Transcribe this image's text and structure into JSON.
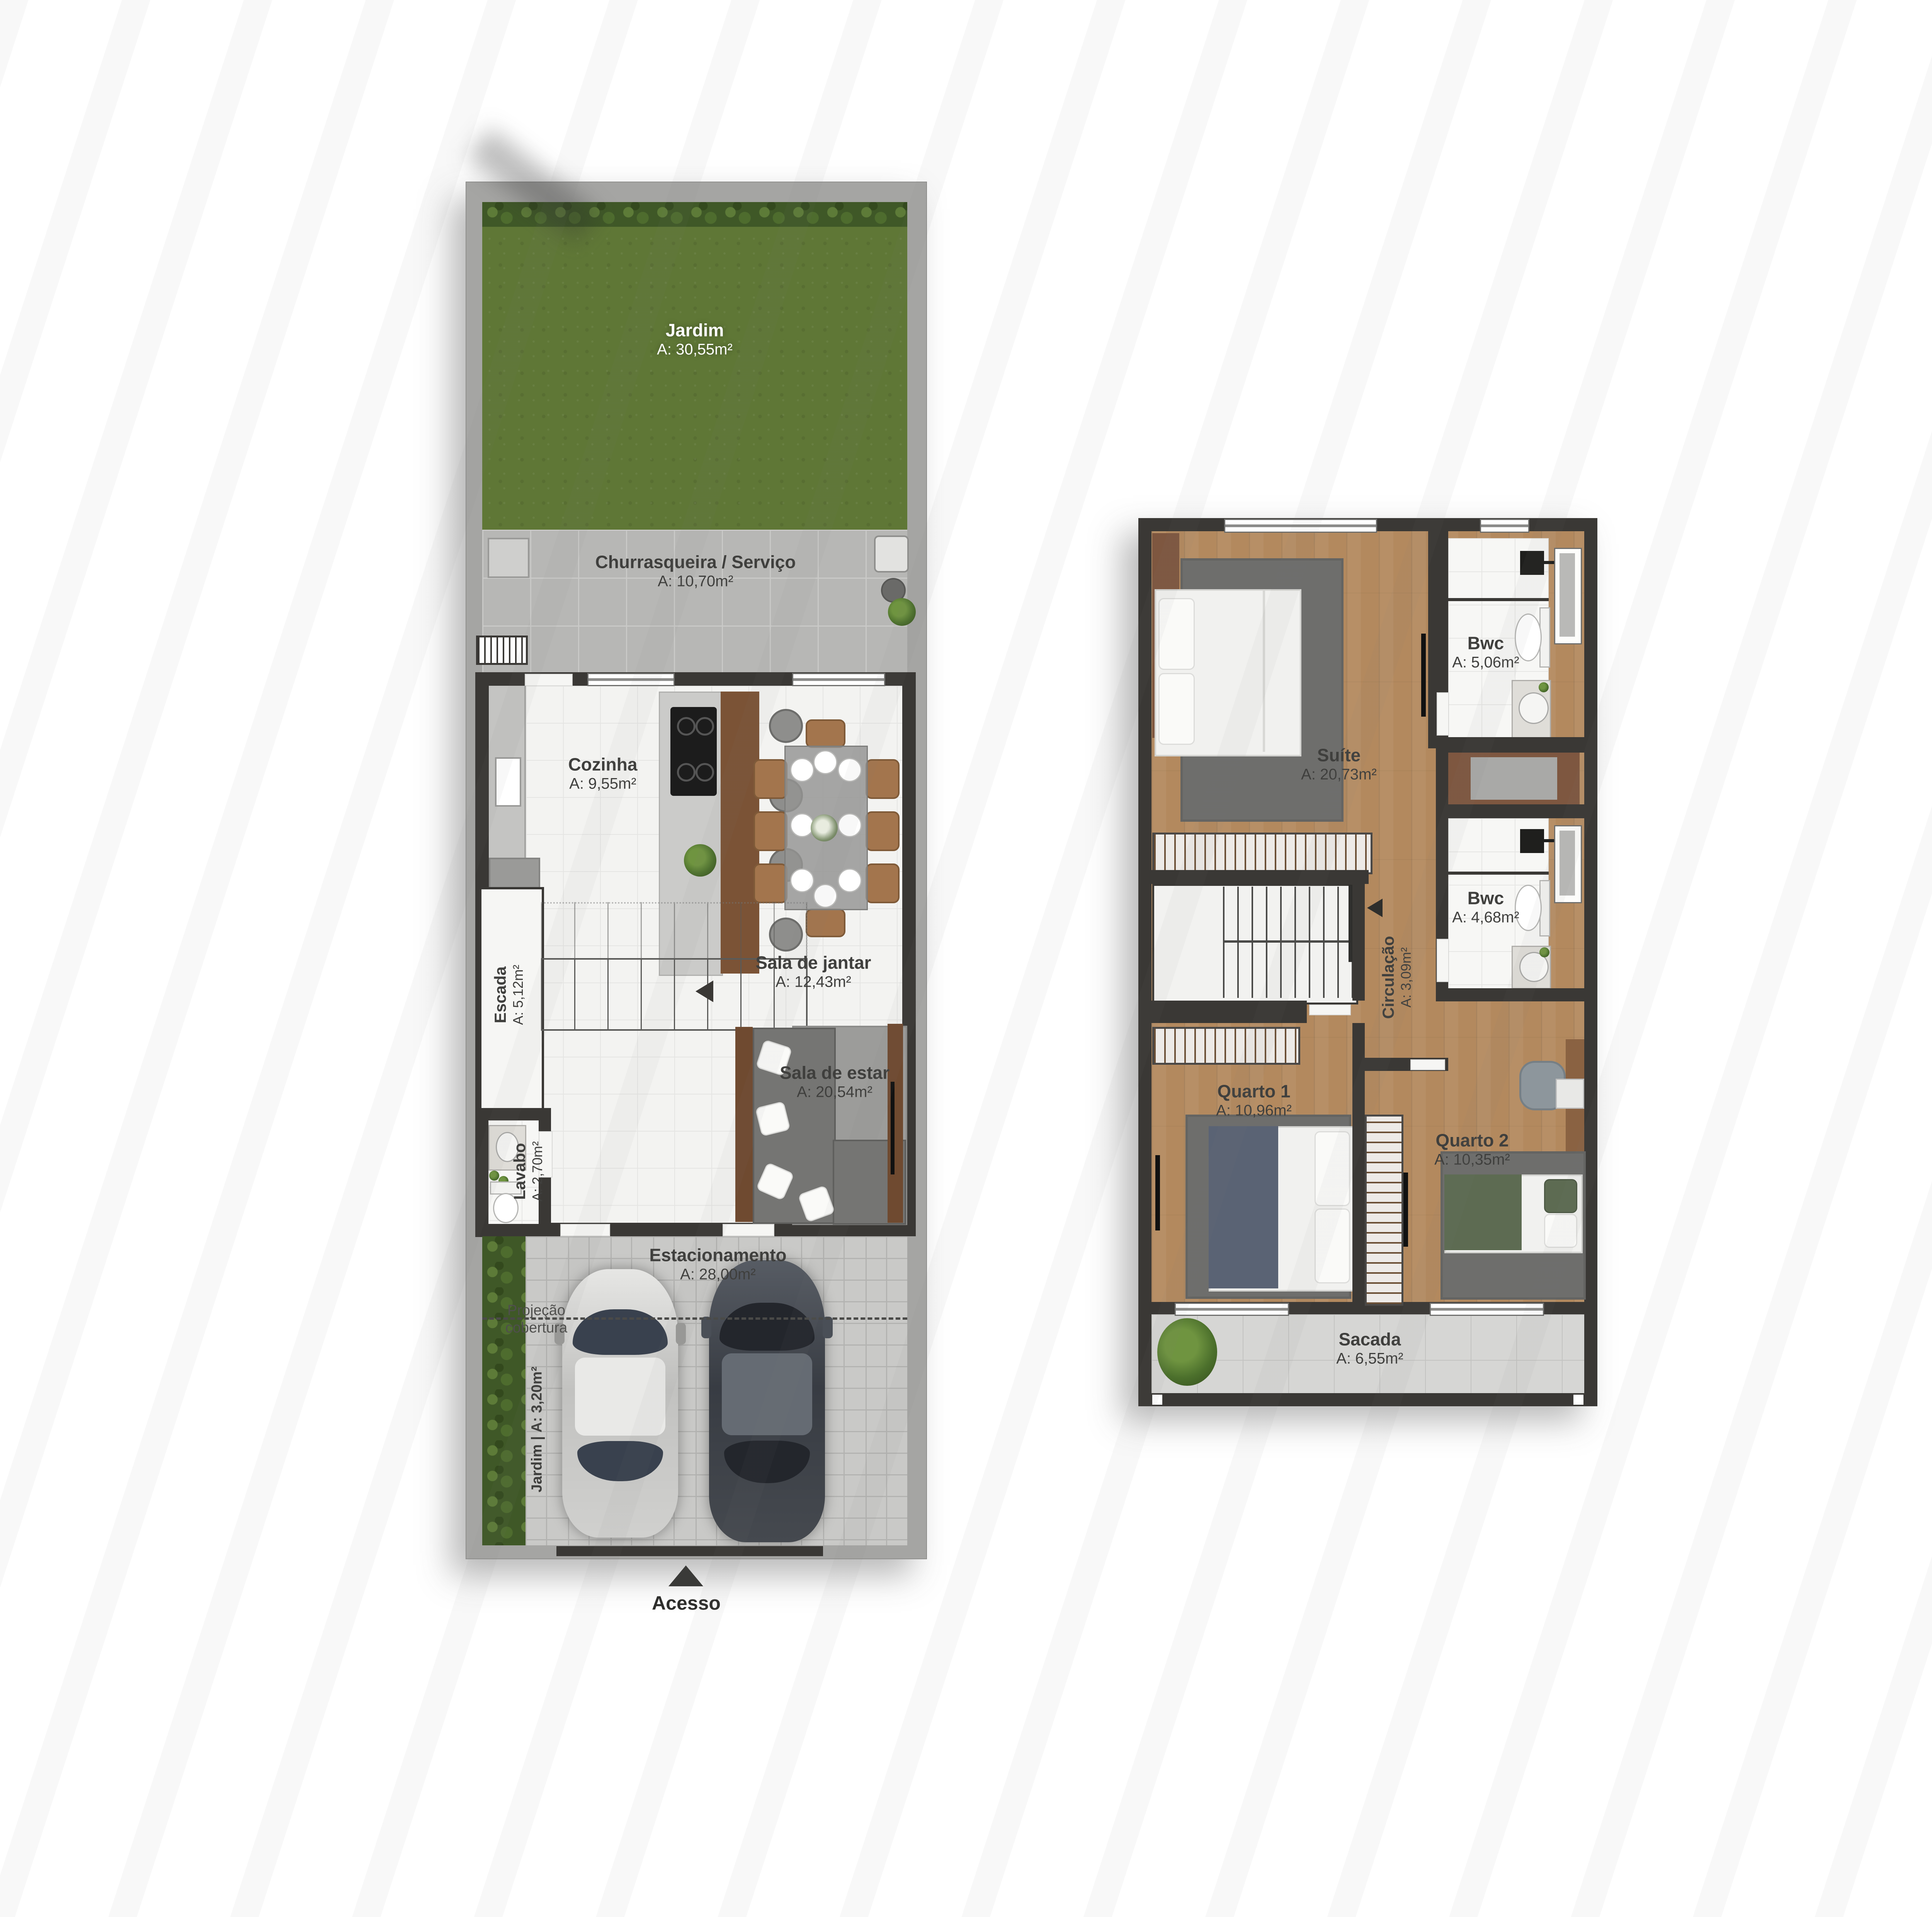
{
  "gf": {
    "jardim": {
      "name": "Jardim",
      "area": "A: 30,55m²"
    },
    "churrasqueira": {
      "name": "Churrasqueira / Serviço",
      "area": "A: 10,70m²"
    },
    "cozinha": {
      "name": "Cozinha",
      "area": "A: 9,55m²"
    },
    "sala_jantar": {
      "name": "Sala de jantar",
      "area": "A: 12,43m²"
    },
    "escada": {
      "name": "Escada",
      "area": "A: 5,12m²"
    },
    "lavabo": {
      "name": "Lavabo",
      "area": "A: 2,70m²"
    },
    "sala_estar": {
      "name": "Sala de estar",
      "area": "A: 20,54m²"
    },
    "estacionamento": {
      "name": "Estacionamento",
      "area": "A: 28,00m²"
    },
    "jardim_lateral": {
      "label": "Jardim | A: 3,20m²"
    },
    "projecao": {
      "line1": "Projeção",
      "line2": "cobertura"
    },
    "acesso": {
      "label": "Acesso"
    }
  },
  "uf": {
    "suite": {
      "name": "Suíte",
      "area": "A: 20,73m²"
    },
    "bwc_suite": {
      "name": "Bwc",
      "area": "A: 5,06m²"
    },
    "bwc_social": {
      "name": "Bwc",
      "area": "A: 4,68m²"
    },
    "circulacao": {
      "name": "Circulação",
      "area": "A: 3,09m²"
    },
    "quarto1": {
      "name": "Quarto 1",
      "area": "A: 10,96m²"
    },
    "quarto2": {
      "name": "Quarto 2",
      "area": "A: 10,35m²"
    },
    "sacada": {
      "name": "Sacada",
      "area": "A: 6,55m²"
    }
  },
  "colors": {
    "wall": "#3a3835",
    "grass": "#5f7736",
    "wood_floor": "#b3895e",
    "rug": "#6e6e6c",
    "white_tile": "#f3f3f1",
    "paver": "#c9c9c7",
    "sidewalk": "#a5a5a3",
    "accent_wood": "#7b5336"
  }
}
